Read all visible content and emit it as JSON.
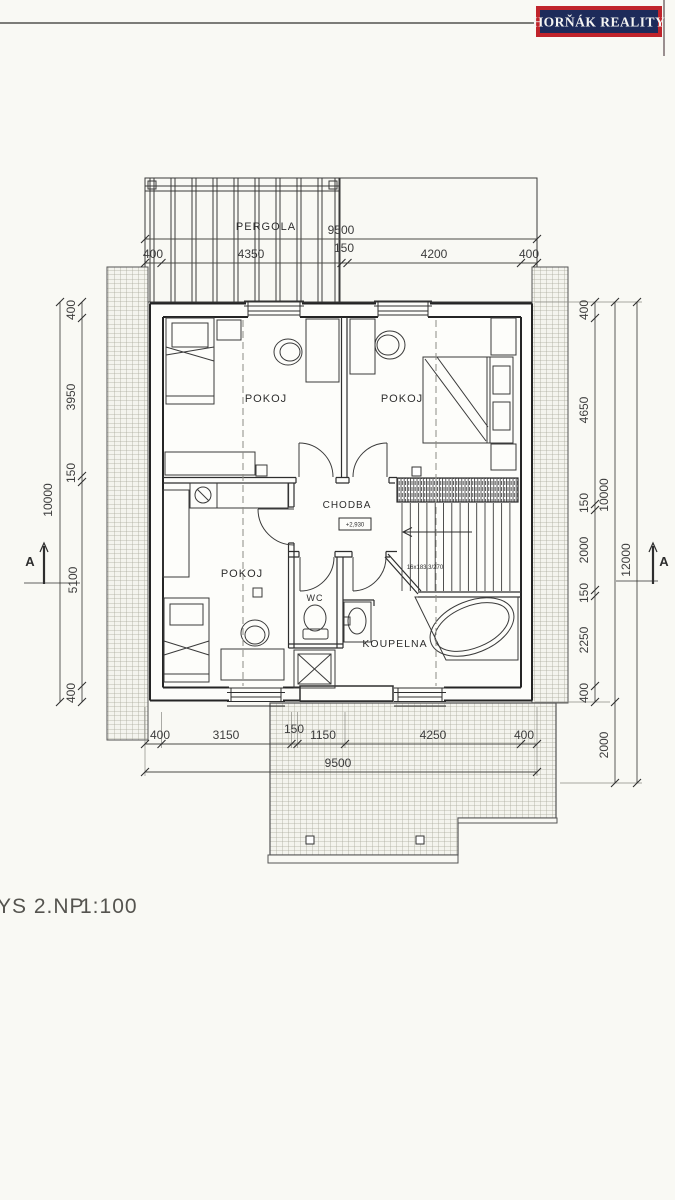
{
  "logo": {
    "text": "HORŇÁK REALITY"
  },
  "title": {
    "name": "YS 2.NP",
    "scale": "1:100"
  },
  "rooms": {
    "pergola": "PERGOLA",
    "pokoj_top_left": "POKOJ",
    "pokoj_top_right": "POKOJ",
    "pokoj_bottom_left": "POKOJ",
    "chodba": "CHODBA",
    "wc": "WC",
    "koupelna": "KOUPELNA"
  },
  "annotations": {
    "level": "+2,930",
    "stair_note": "16x183,3/270",
    "section_left": "A",
    "section_right": "A"
  },
  "dims": {
    "top": {
      "total": "9500",
      "chain": [
        "400",
        "4350",
        "150",
        "4200",
        "400"
      ]
    },
    "bottom": {
      "total": "9500",
      "chain": [
        "400",
        "3150",
        "150",
        "1150",
        "4250",
        "400"
      ]
    },
    "left": {
      "total": "10000",
      "chain": [
        "400",
        "3950",
        "150",
        "5100",
        "400"
      ]
    },
    "right": {
      "total": "10000",
      "chain": [
        "400",
        "4650",
        "150",
        "2000",
        "150",
        "2250",
        "400"
      ],
      "below": "2000",
      "overall": "12000"
    }
  },
  "colors": {
    "logo_bg": "#1d2b5a",
    "logo_border": "#c0242b",
    "ink": "#2e2e2e",
    "paper": "#f9f9f4"
  }
}
